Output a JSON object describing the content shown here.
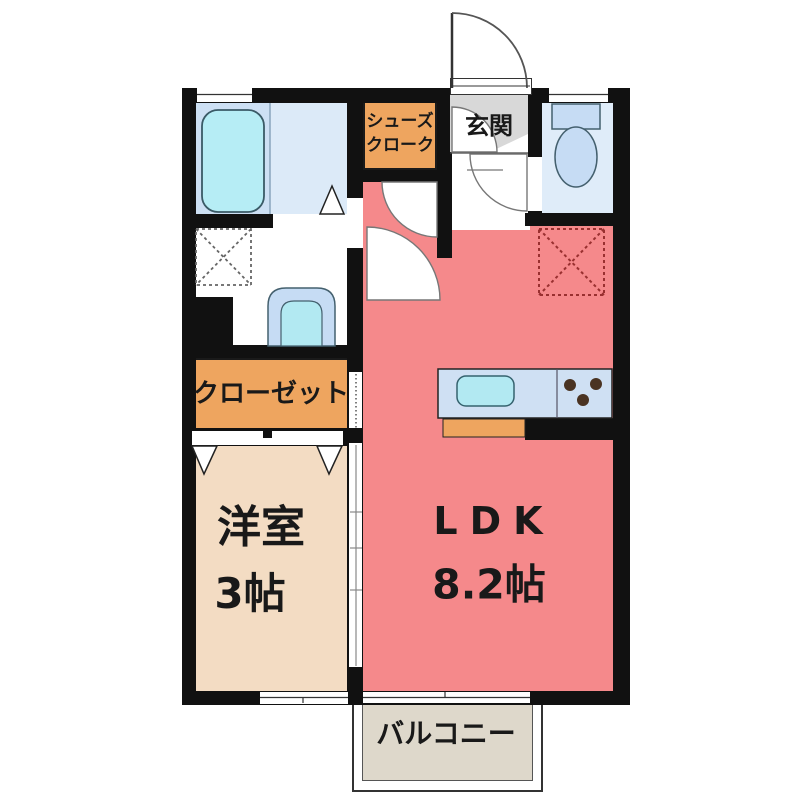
{
  "floorplan": {
    "entrance": {
      "label": "玄関"
    },
    "shoe_closet": {
      "label": "シューズクローク",
      "line1": "シューズ",
      "line2": "クローク"
    },
    "closet": {
      "label": "クローゼット"
    },
    "western_room": {
      "name": "洋室",
      "size": "3帖"
    },
    "ldk": {
      "name": "LDK",
      "size": "8.2帖"
    },
    "balcony": {
      "label": "バルコニー"
    }
  },
  "colors": {
    "wall": "#111111",
    "ldk_floor": "#F5898B",
    "western_room_floor": "#F3DCC3",
    "storage_orange": "#EEA55F",
    "bathroom_left": "#CDE0F4",
    "bathroom_right": "#DCEAF8",
    "toilet_room": "#DFECF9",
    "fixture_blue": "#C6DCF4",
    "bathtub_cyan": "#B6EDF5",
    "sink_cyan": "#B2E9F2",
    "kitchen_counter_blue": "#CFE0F3",
    "entrance_gray": "#D8D8D8",
    "balcony_floor": "#DED8CB",
    "burner_brown": "#4A3322",
    "fridge_dash_red": "#993030"
  },
  "fixtures": {
    "bathtub": "bathtub",
    "toilet": "toilet",
    "washbasin": "washbasin",
    "washing_machine_pan": "washing-machine pan (dashed square)",
    "refrigerator_space": "refrigerator space (dashed square)",
    "kitchen_sink": "kitchen sink",
    "stove": "three-burner stove",
    "doors": "swing doors, folding doors and sliding doors"
  }
}
